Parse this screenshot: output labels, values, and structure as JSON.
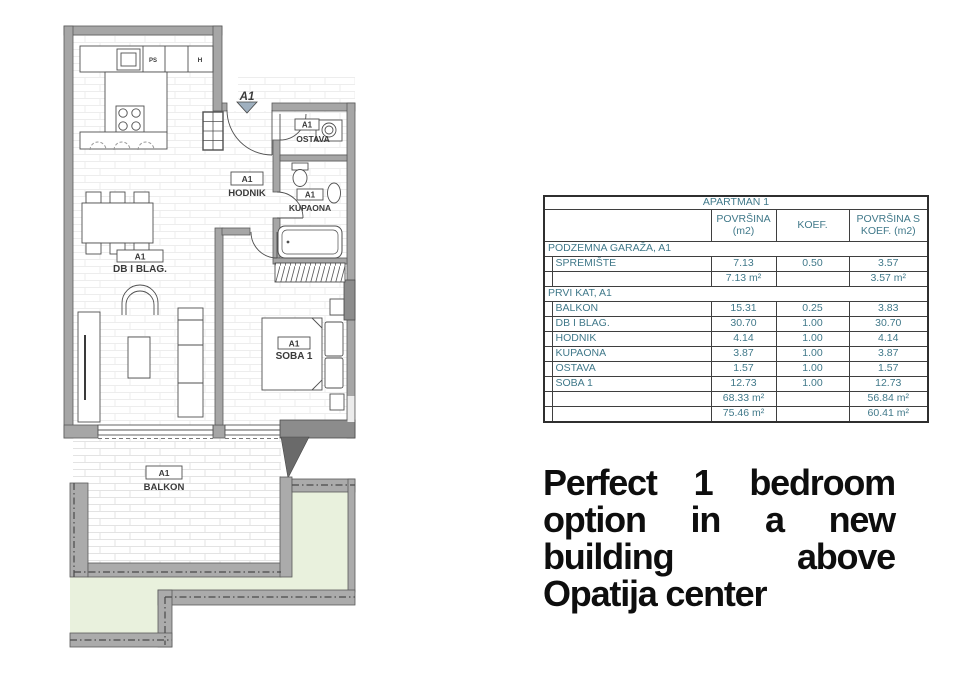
{
  "plan": {
    "entrance_code": "A1",
    "kitchen": {
      "ps": "PS",
      "h": "H"
    },
    "rooms": {
      "hodnik": {
        "code": "A1",
        "name": "HODNIK"
      },
      "ostava": {
        "code": "A1",
        "name": "OSTAVA"
      },
      "kupaona": {
        "code": "A1",
        "name": "KUPAONA"
      },
      "db_blag": {
        "code": "A1",
        "name": "DB I BLAG."
      },
      "soba1": {
        "code": "A1",
        "name": "SOBA 1"
      },
      "balkon": {
        "code": "A1",
        "name": "BALKON"
      }
    },
    "colors": {
      "wall": "#a6a6a6",
      "wall_dark": "#8c8c8c",
      "green": "#e9f1dd",
      "accent_text": "#41798a"
    }
  },
  "table": {
    "title": "APARTMAN 1",
    "columns": {
      "area_line1": "POVRŠINA",
      "area_line2": "(m2)",
      "koef": "KOEF.",
      "area_koef_line1": "POVRŠINA S",
      "area_koef_line2": "KOEF. (m2)"
    },
    "sections": [
      {
        "header": "PODZEMNA GARAŽA, A1",
        "rows": [
          {
            "name": "SPREMIŠTE",
            "area": "7.13",
            "koef": "0.50",
            "area_koef": "3.57"
          }
        ],
        "totals": [
          {
            "area": "7.13 m²",
            "area_koef": "3.57 m²"
          }
        ]
      },
      {
        "header": "PRVI KAT, A1",
        "rows": [
          {
            "name": "BALKON",
            "area": "15.31",
            "koef": "0.25",
            "area_koef": "3.83"
          },
          {
            "name": "DB I BLAG.",
            "area": "30.70",
            "koef": "1.00",
            "area_koef": "30.70"
          },
          {
            "name": "HODNIK",
            "area": "4.14",
            "koef": "1.00",
            "area_koef": "4.14"
          },
          {
            "name": "KUPAONA",
            "area": "3.87",
            "koef": "1.00",
            "area_koef": "3.87"
          },
          {
            "name": "OSTAVA",
            "area": "1.57",
            "koef": "1.00",
            "area_koef": "1.57"
          },
          {
            "name": "SOBA 1",
            "area": "12.73",
            "koef": "1.00",
            "area_koef": "12.73"
          }
        ],
        "totals": [
          {
            "area": "68.33 m²",
            "area_koef": "56.84 m²"
          },
          {
            "area": "75.46 m²",
            "area_koef": "60.41 m²"
          }
        ]
      }
    ]
  },
  "headline": {
    "line1": "Perfect 1 bedroom",
    "line2": "option in a new",
    "line3": "building above",
    "line4": "Opatija center"
  }
}
